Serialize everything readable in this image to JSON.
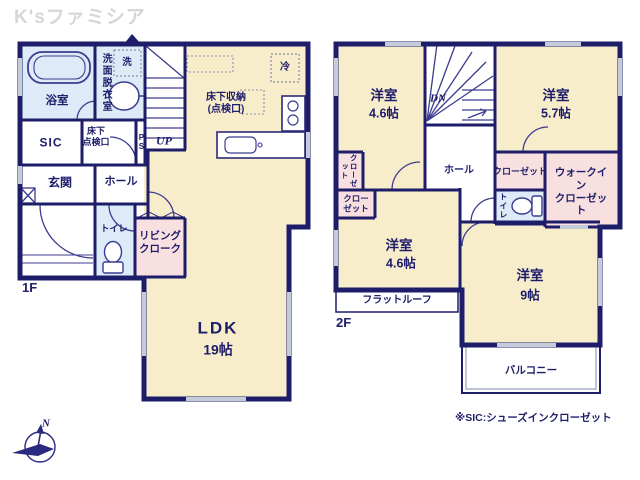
{
  "watermark": "K'sファミシア",
  "footnote": "※SIC:シューズインクローゼット",
  "compass": {
    "north": "N"
  },
  "colors": {
    "wall": "#1d1d6a",
    "room_cream": "#f8edcb",
    "wet_blue": "#dcebf7",
    "closet_pink": "#f9e0e0",
    "window_gray": "#c6cbda",
    "inner_line": "#3c3c90",
    "watermark_gray": "#d6d6d6"
  },
  "floor1": {
    "floor_label": "1F",
    "bath": "浴室",
    "washroom": "洗面脱衣室",
    "washer": "洗",
    "stairs_up": "UP",
    "underfloor_storage": "床下収納\n(点検口)",
    "fridge": "冷",
    "sic": "SIC",
    "underfloor_hatch": "床下\n点検口",
    "ps": "PS",
    "entrance": "玄関",
    "hall": "ホール",
    "toilet": "トイレ",
    "living_closet": "リビング\nクローク",
    "ldk": "LDK",
    "ldk_size": "19帖"
  },
  "floor2": {
    "floor_label": "2F",
    "room_nw": "洋室",
    "room_nw_size": "4.6帖",
    "stairs_dn": "DN",
    "room_ne": "洋室",
    "room_ne_size": "5.7帖",
    "closet_nw": "クローゼット",
    "closet_w": "クロー\nゼット",
    "hall": "ホール",
    "closet_mid": "クローゼット",
    "walkin_closet": "ウォークイン\nクローゼット",
    "toilet": "トイレ",
    "room_sw": "洋室",
    "room_sw_size": "4.6帖",
    "room_se": "洋室",
    "room_se_size": "9帖",
    "flat_roof": "フラットルーフ",
    "balcony": "バルコニー"
  }
}
